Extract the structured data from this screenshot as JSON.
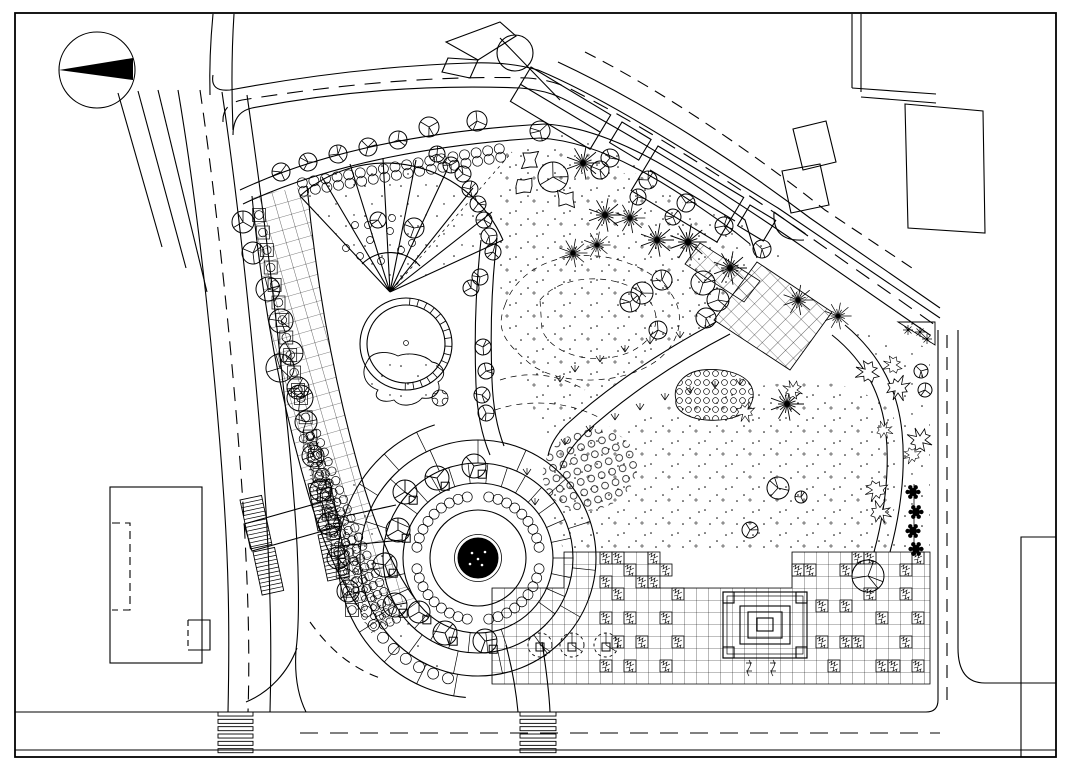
{
  "document": {
    "kind": "landscape-architecture-site-plan",
    "visible_text": [],
    "colors": {
      "ink": "#000000",
      "paper": "#ffffff"
    },
    "icons": {
      "north_arrow": "north-arrow-icon"
    }
  },
  "plan": {
    "trees": [
      [
        243,
        222,
        11
      ],
      [
        253,
        253,
        11
      ],
      [
        268,
        289,
        12
      ],
      [
        281,
        321,
        12
      ],
      [
        291,
        353,
        12
      ],
      [
        298,
        388,
        11
      ],
      [
        306,
        422,
        11
      ],
      [
        313,
        456,
        11
      ],
      [
        321,
        490,
        11
      ],
      [
        329,
        524,
        11
      ],
      [
        338,
        558,
        11
      ],
      [
        348,
        591,
        11
      ],
      [
        281,
        172,
        9
      ],
      [
        308,
        162,
        9
      ],
      [
        338,
        154,
        9
      ],
      [
        368,
        147,
        9
      ],
      [
        398,
        140,
        9
      ],
      [
        429,
        127,
        10
      ],
      [
        477,
        121,
        10
      ],
      [
        540,
        131,
        10
      ],
      [
        610,
        158,
        9
      ],
      [
        648,
        180,
        9
      ],
      [
        686,
        203,
        9
      ],
      [
        724,
        226,
        9
      ],
      [
        762,
        249,
        9
      ],
      [
        437,
        154,
        8
      ],
      [
        451,
        165,
        8
      ],
      [
        463,
        174,
        8
      ],
      [
        470,
        189,
        8
      ],
      [
        478,
        204,
        8
      ],
      [
        484,
        220,
        8
      ],
      [
        489,
        236,
        8
      ],
      [
        493,
        252,
        8
      ],
      [
        480,
        277,
        8
      ],
      [
        471,
        288,
        8
      ],
      [
        483,
        347,
        8
      ],
      [
        486,
        371,
        8
      ],
      [
        482,
        395,
        8
      ],
      [
        486,
        413,
        8
      ],
      [
        378,
        220,
        8
      ],
      [
        414,
        228,
        10
      ],
      [
        280,
        368,
        14
      ],
      [
        300,
        398,
        13
      ],
      [
        553,
        177,
        15
      ],
      [
        600,
        170,
        9
      ],
      [
        638,
        197,
        8
      ],
      [
        673,
        217,
        8
      ],
      [
        642,
        293,
        11
      ],
      [
        662,
        280,
        10
      ],
      [
        703,
        283,
        12
      ],
      [
        718,
        300,
        11
      ],
      [
        706,
        318,
        10
      ],
      [
        658,
        330,
        9
      ],
      [
        630,
        302,
        10
      ],
      [
        778,
        488,
        11
      ],
      [
        801,
        497,
        6
      ],
      [
        750,
        530,
        8
      ],
      [
        868,
        576,
        16
      ],
      [
        921,
        371,
        7
      ],
      [
        925,
        390,
        7
      ]
    ],
    "plaza_trees": [
      [
        405,
        492,
        12
      ],
      [
        437,
        478,
        12
      ],
      [
        474,
        466,
        12
      ],
      [
        398,
        530,
        12
      ],
      [
        385,
        565,
        12
      ],
      [
        395,
        605,
        12
      ],
      [
        419,
        612,
        11
      ],
      [
        445,
        633,
        12
      ],
      [
        485,
        641,
        12
      ]
    ],
    "dashed_trees": [
      [
        540,
        645,
        12
      ],
      [
        572,
        645,
        12
      ],
      [
        606,
        645,
        12
      ]
    ],
    "palms": [
      [
        583,
        163,
        1
      ],
      [
        605,
        215,
        1
      ],
      [
        630,
        218,
        0.9
      ],
      [
        657,
        240,
        1
      ],
      [
        573,
        253,
        0.85
      ],
      [
        597,
        245,
        0.8
      ],
      [
        688,
        242,
        1.1
      ],
      [
        730,
        268,
        1
      ],
      [
        798,
        300,
        0.9
      ],
      [
        838,
        316,
        0.8
      ],
      [
        787,
        404,
        1
      ]
    ],
    "shrubs": [
      [
        868,
        372,
        1
      ],
      [
        898,
        388,
        1
      ],
      [
        920,
        440,
        1
      ],
      [
        876,
        490,
        0.9
      ],
      [
        880,
        512,
        0.9
      ],
      [
        893,
        365,
        0.8
      ],
      [
        745,
        412,
        0.8
      ],
      [
        793,
        390,
        0.8
      ],
      [
        912,
        455,
        0.7
      ],
      [
        884,
        430,
        0.7
      ]
    ],
    "rocks": [
      [
        530,
        160
      ],
      [
        524,
        186
      ],
      [
        566,
        199
      ]
    ],
    "flowers": [
      [
        913,
        492
      ],
      [
        916,
        512
      ],
      [
        913,
        531
      ],
      [
        916,
        549
      ]
    ],
    "fan_dots": [
      [
        355,
        225
      ],
      [
        370,
        240
      ],
      [
        390,
        231
      ],
      [
        360,
        256
      ],
      [
        381,
        261
      ],
      [
        401,
        250
      ],
      [
        346,
        248
      ],
      [
        412,
        243
      ],
      [
        368,
        225
      ],
      [
        392,
        218
      ]
    ],
    "tufts": [
      [
        575,
        372
      ],
      [
        600,
        362
      ],
      [
        625,
        352
      ],
      [
        650,
        344
      ],
      [
        560,
        382
      ],
      [
        680,
        338
      ],
      [
        565,
        445
      ],
      [
        590,
        432
      ],
      [
        615,
        420
      ],
      [
        640,
        410
      ],
      [
        665,
        400
      ],
      [
        690,
        393
      ],
      [
        715,
        388
      ],
      [
        740,
        385
      ],
      [
        527,
        475
      ],
      [
        535,
        505
      ]
    ],
    "hedge_lines": [
      [
        303,
        187,
        500,
        153,
        2,
        18,
        5
      ],
      [
        310,
        436,
        352,
        540,
        3,
        12,
        4.2
      ],
      [
        352,
        540,
        390,
        622,
        3,
        10,
        4.2
      ]
    ],
    "hedge_arcs": [
      [
        478,
        558,
        62,
        100,
        170,
        9,
        5
      ],
      [
        478,
        558,
        62,
        190,
        260,
        9,
        5
      ],
      [
        478,
        558,
        62,
        280,
        350,
        9,
        5
      ],
      [
        478,
        558,
        62,
        10,
        80,
        9,
        5
      ],
      [
        478,
        558,
        124,
        104,
        176,
        11,
        5.5
      ]
    ],
    "hedge_squares": [
      [
        259,
        215,
        298,
        390,
        11
      ],
      [
        301,
        398,
        352,
        610,
        12
      ]
    ],
    "planting_cells": [
      [
        600,
        552
      ],
      [
        612,
        552
      ],
      [
        648,
        552
      ],
      [
        624,
        564
      ],
      [
        600,
        576
      ],
      [
        636,
        576
      ],
      [
        648,
        576
      ],
      [
        612,
        588
      ],
      [
        600,
        612
      ],
      [
        624,
        612
      ],
      [
        660,
        564
      ],
      [
        672,
        588
      ],
      [
        612,
        636
      ],
      [
        660,
        612
      ],
      [
        636,
        636
      ],
      [
        672,
        636
      ],
      [
        600,
        660
      ],
      [
        624,
        660
      ],
      [
        660,
        660
      ],
      [
        792,
        564
      ],
      [
        804,
        564
      ],
      [
        840,
        564
      ],
      [
        852,
        552
      ],
      [
        864,
        552
      ],
      [
        816,
        600
      ],
      [
        840,
        600
      ],
      [
        864,
        588
      ],
      [
        816,
        636
      ],
      [
        840,
        636
      ],
      [
        852,
        636
      ],
      [
        876,
        612
      ],
      [
        900,
        564
      ],
      [
        900,
        588
      ],
      [
        876,
        660
      ],
      [
        900,
        636
      ],
      [
        912,
        552
      ],
      [
        912,
        612
      ],
      [
        888,
        660
      ],
      [
        912,
        660
      ],
      [
        828,
        660
      ]
    ],
    "crosswalks": [
      [
        218,
        712,
        35,
        44,
        6
      ],
      [
        520,
        712,
        36,
        44,
        6
      ]
    ],
    "steps": [
      [
        240,
        500,
        22,
        50,
        -12
      ],
      [
        308,
        484,
        22,
        48,
        -12
      ],
      [
        253,
        552,
        22,
        44,
        -12
      ],
      [
        318,
        535,
        22,
        47,
        -12
      ]
    ],
    "plaza": {
      "cx": 478,
      "cy": 558,
      "r_center": 20,
      "rings": [
        48,
        75,
        95,
        118
      ],
      "outer_ring": 140
    },
    "pond": {
      "cx": 406,
      "cy": 344,
      "r_outer": 46,
      "r_inner": 39
    }
  }
}
